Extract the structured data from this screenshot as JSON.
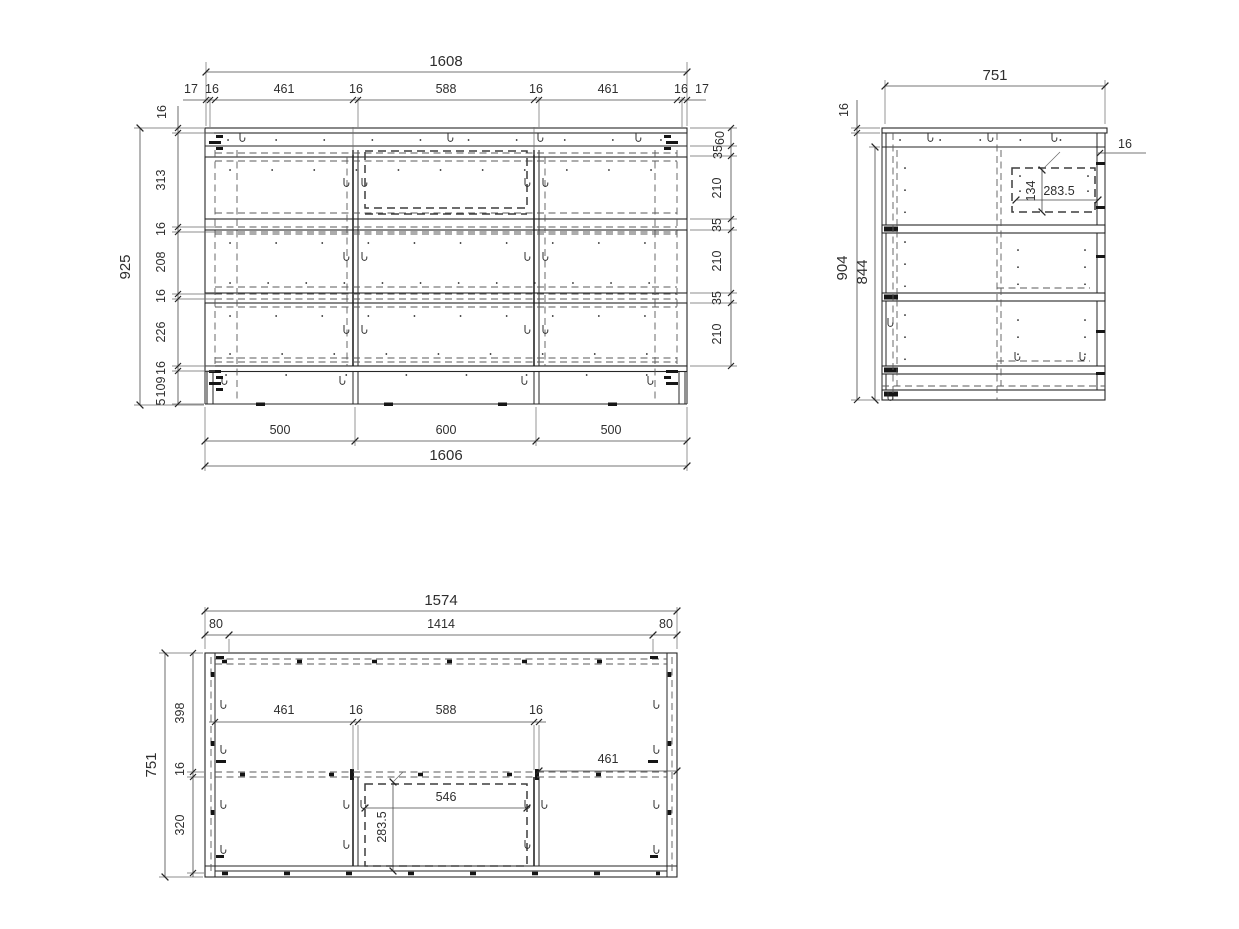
{
  "front_view": {
    "dim_overall_width_top": "1608",
    "dim_top_chain": [
      "17",
      "16",
      "461",
      "16",
      "588",
      "16",
      "461",
      "16",
      "17"
    ],
    "dim_overall_height": "925",
    "dim_left_top_thickness": "16",
    "dim_left_chain": [
      "313",
      "16",
      "208",
      "16",
      "226",
      "16",
      "109",
      "5"
    ],
    "dim_right_chain": [
      "60",
      "35",
      "210",
      "35",
      "210",
      "35",
      "210"
    ],
    "dim_bottom_chain": [
      "500",
      "600",
      "500"
    ],
    "dim_overall_width_bottom": "1606"
  },
  "side_view": {
    "dim_overall_depth": "751",
    "dim_top_panel_thickness_left": "16",
    "dim_top_panel_thickness_right": "16",
    "dim_overall_height": "904",
    "dim_carcass_height": "844",
    "dim_slide_offset_height": "134",
    "dim_slide_offset_depth": "283.5"
  },
  "top_view": {
    "dim_overall_width": "1574",
    "dim_left_offset": "80",
    "dim_inner_width": "1414",
    "dim_right_offset": "80",
    "dim_overall_depth": "751",
    "dim_depth_chain": [
      "398",
      "16",
      "320"
    ],
    "dim_inner_chain": [
      "461",
      "16",
      "588",
      "16"
    ],
    "dim_right_bay_width": "461",
    "dim_center_bay_inner_width": "546",
    "dim_drawer_depth": "283.5"
  }
}
